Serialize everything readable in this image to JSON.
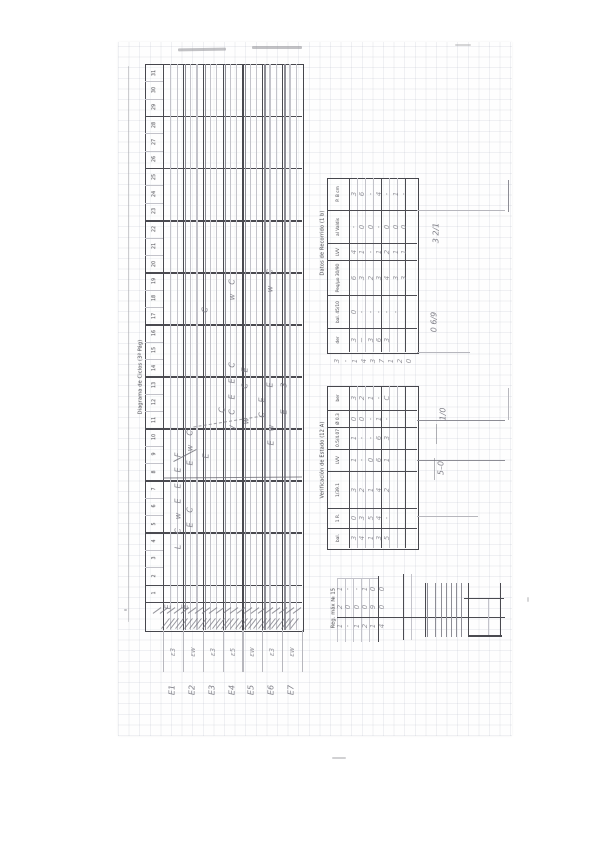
{
  "colors": {
    "paper": "#fefefe",
    "ink": "#3a3a40",
    "pencil": "#70707a",
    "grid_line": "#969eaf"
  },
  "diagram": {
    "title": "Diagrama de Ciclos (3ª Pág)",
    "column_numbers": [
      "31",
      "30",
      "29",
      "28",
      "27",
      "26",
      "25",
      "24",
      "23",
      "22",
      "21",
      "20",
      "19",
      "18",
      "17",
      "16",
      "15",
      "14",
      "13",
      "12",
      "11",
      "10",
      "9",
      "8",
      "7",
      "6",
      "5",
      "4",
      "3",
      "2",
      "1"
    ],
    "marks": [
      {
        "x": 178,
        "y": 455,
        "ch": "F"
      },
      {
        "x": 178,
        "y": 470,
        "ch": "E"
      },
      {
        "x": 178,
        "y": 486,
        "ch": "E"
      },
      {
        "x": 178,
        "y": 501,
        "ch": "E"
      },
      {
        "x": 178,
        "y": 516,
        "ch": "w"
      },
      {
        "x": 178,
        "y": 531,
        "ch": "C"
      },
      {
        "x": 178,
        "y": 547,
        "ch": "L"
      },
      {
        "x": 190,
        "y": 433,
        "ch": "C"
      },
      {
        "x": 190,
        "y": 448,
        "ch": "w"
      },
      {
        "x": 190,
        "y": 463,
        "ch": "E"
      },
      {
        "x": 190,
        "y": 510,
        "ch": "C"
      },
      {
        "x": 190,
        "y": 525,
        "ch": "E"
      },
      {
        "x": 205,
        "y": 310,
        "ch": "C"
      },
      {
        "x": 206,
        "y": 456,
        "ch": "E"
      },
      {
        "x": 222,
        "y": 410,
        "ch": "C"
      },
      {
        "x": 232,
        "y": 282,
        "ch": "C"
      },
      {
        "x": 232,
        "y": 297,
        "ch": "w"
      },
      {
        "x": 232,
        "y": 365,
        "ch": "C"
      },
      {
        "x": 232,
        "y": 381,
        "ch": "E"
      },
      {
        "x": 232,
        "y": 397,
        "ch": "E"
      },
      {
        "x": 232,
        "y": 412,
        "ch": "C"
      },
      {
        "x": 233,
        "y": 428,
        "ch": "V"
      },
      {
        "x": 245,
        "y": 370,
        "ch": "E"
      },
      {
        "x": 245,
        "y": 386,
        "ch": "C"
      },
      {
        "x": 246,
        "y": 421,
        "ch": "w"
      },
      {
        "x": 262,
        "y": 400,
        "ch": "E"
      },
      {
        "x": 262,
        "y": 415,
        "ch": "C"
      },
      {
        "x": 270,
        "y": 272,
        "ch": "C"
      },
      {
        "x": 270,
        "y": 289,
        "ch": "w"
      },
      {
        "x": 270,
        "y": 385,
        "ch": "E"
      },
      {
        "x": 271,
        "y": 428,
        "ch": "w"
      },
      {
        "x": 271,
        "y": 443,
        "ch": "E"
      },
      {
        "x": 284,
        "y": 385,
        "ch": "3"
      },
      {
        "x": 284,
        "y": 412,
        "ch": "E"
      },
      {
        "x": 168,
        "y": 607,
        "ch": "E"
      },
      {
        "x": 185,
        "y": 607,
        "ch": "E"
      }
    ],
    "column_notes": [
      "ε3",
      "εw",
      "ε3",
      "ε5",
      "εw",
      "ε3",
      "εw"
    ],
    "column_labels": [
      "E1",
      "E2",
      "E3",
      "E4",
      "E5",
      "E6",
      "E7"
    ]
  },
  "table1": {
    "title": "Datos de Recorrido (1 b)",
    "rows": [
      {
        "label": "P. B cm",
        "cells": [
          "3",
          "6",
          "-",
          "4",
          "-",
          "1",
          "-"
        ]
      },
      {
        "label": "al Valdis",
        "cells": [
          "-",
          "0",
          "0",
          "-",
          "0",
          "0",
          "0"
        ]
      },
      {
        "label": "LVV",
        "cells": [
          "4",
          "1",
          "-",
          "1",
          "2",
          "1",
          "1"
        ]
      },
      {
        "label": "Peq/μo 30/90",
        "cells": [
          "6",
          "3",
          "2",
          "3",
          "4",
          "3",
          "3"
        ]
      },
      {
        "label": "bal. 45/10",
        "cells": [
          "0",
          "-",
          "-",
          "-",
          "-",
          "-"
        ]
      },
      {
        "label": "der",
        "cells": [
          "3",
          "~",
          "3",
          "6",
          "3"
        ]
      }
    ],
    "footnote_digits": [
      "3",
      "-",
      "1",
      "4",
      "3",
      "7",
      "1",
      "2",
      "0"
    ]
  },
  "table2": {
    "title": "Verificación de Estado (12 A)",
    "rows": [
      {
        "label": "ber",
        "cells": [
          "3",
          "2",
          "1",
          "-",
          "C"
        ]
      },
      {
        "label": "Ø 0.3",
        "cells": [
          "0",
          "0",
          "-",
          "1",
          "-"
        ]
      },
      {
        "label": "0.5/4.07",
        "cells": [
          "1",
          "-",
          "-",
          "6",
          "3"
        ]
      },
      {
        "label": "LVV",
        "cells": [
          "1",
          "-",
          "0",
          "6",
          "1"
        ]
      },
      {
        "label": "1/39.1",
        "cells": [
          "3",
          "2",
          "1",
          "4",
          "2"
        ]
      },
      {
        "label": "1 R.",
        "cells": [
          "0",
          "3",
          "5",
          "4",
          "-"
        ]
      },
      {
        "label": "bal.",
        "cells": [
          "3",
          "4",
          "1",
          "3",
          "5"
        ]
      }
    ]
  },
  "table3": {
    "title": "Reg. máx № 15",
    "rows": [
      [
        "1",
        "-",
        "-",
        "1",
        "0",
        "0"
      ],
      [
        "2",
        "0",
        "0",
        "0",
        "9",
        "0"
      ],
      [
        "1",
        "-",
        "1",
        "2",
        "1",
        "4"
      ]
    ]
  },
  "annotations": [
    {
      "text": "3 2/1",
      "x": 436,
      "y": 233
    },
    {
      "text": "0 6/9",
      "x": 434,
      "y": 322
    },
    {
      "text": "1/0",
      "x": 443,
      "y": 414
    },
    {
      "text": "5–0",
      "x": 441,
      "y": 468
    }
  ]
}
